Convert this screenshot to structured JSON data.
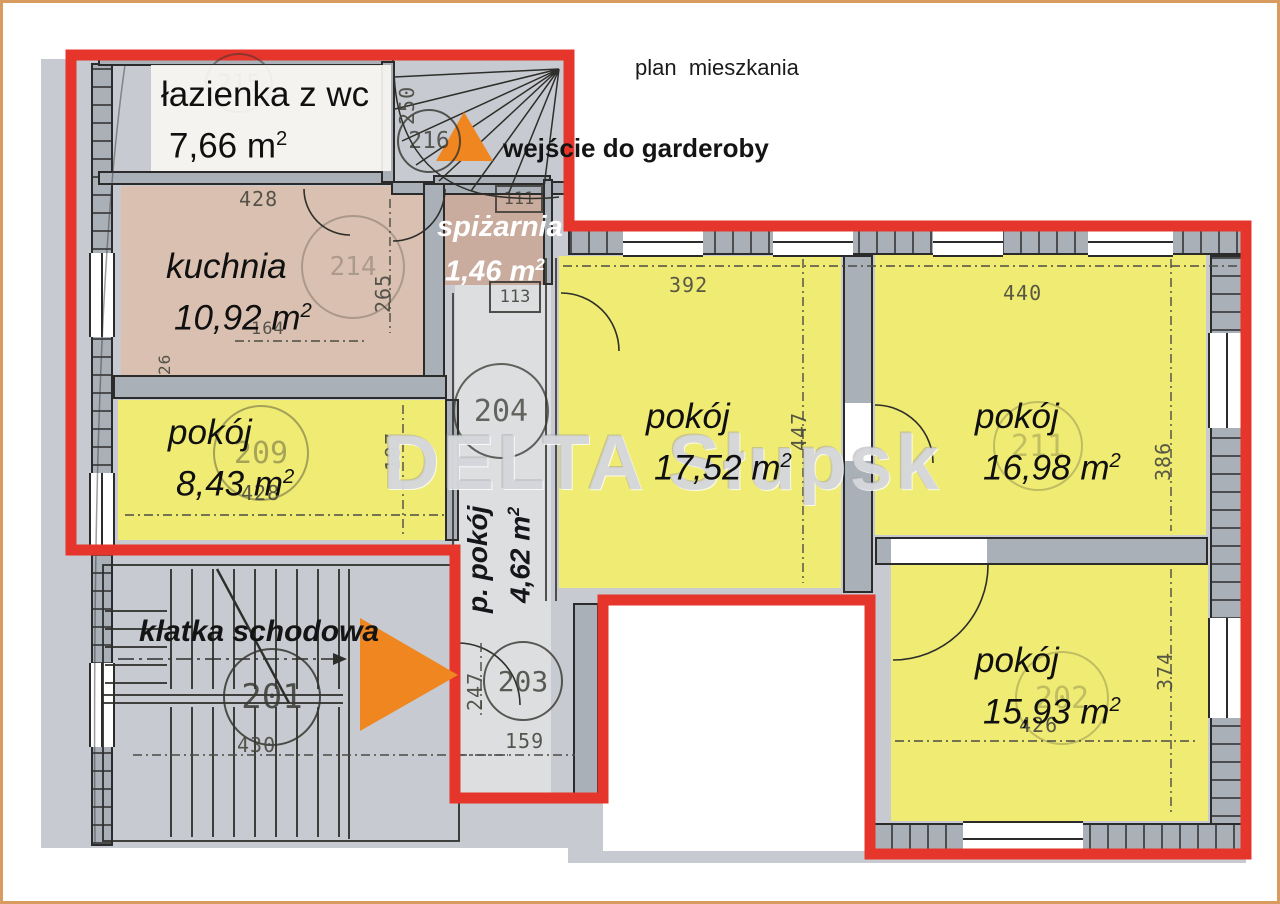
{
  "title": "plan  mieszkania",
  "watermark": "DELTA Słupsk",
  "labels": {
    "wardrobe_entrance": "wejście do garderoby",
    "staircase": "klatka schodowa"
  },
  "units": {
    "m": "m",
    "sup": "2"
  },
  "rooms": {
    "lazienka": {
      "name": "łazienka z wc",
      "area": "7,66"
    },
    "kuchnia": {
      "name": "kuchnia",
      "area": "10,92"
    },
    "pokoj_maly": {
      "name": "pokój",
      "area": "8,43"
    },
    "spizarnia": {
      "name": "spiżarnia",
      "area": "1,46"
    },
    "przedpokoj": {
      "name": "p. pokój",
      "area": "4,62"
    },
    "pokoj_17": {
      "name": "pokój",
      "area": "17,52"
    },
    "pokoj_16": {
      "name": "pokój",
      "area": "16,98"
    },
    "pokoj_15": {
      "name": "pokój",
      "area": "15,93"
    }
  },
  "dims": {
    "kuchnia_top": "428",
    "kuchnia_right": "265",
    "stairs_top": "250",
    "kuchnia_inner": "164",
    "kuchnia_small": "26",
    "pokoj_maly_right": "197",
    "pokoj_maly_bottom": "428",
    "pokoj_17_top": "392",
    "pokoj_17_right": "447",
    "pokoj_16_top": "440",
    "pokoj_16_right": "386",
    "pokoj_15_bottom": "426",
    "pokoj_15_right": "374",
    "stairs_bottom": "430",
    "przedpokoj_bottom": "159",
    "przedpokoj_left": "247"
  },
  "numbers": {
    "c215": "215",
    "c216": "216",
    "c214": "214",
    "c209": "209",
    "c204": "204",
    "c201": "201",
    "c203": "203",
    "c211": "211",
    "c202": "202",
    "b111": "111",
    "b113": "113"
  },
  "colors": {
    "outline_red": "#e6352b",
    "arrow_orange": "#f0861f",
    "room_yellow": "#f2ee6c",
    "scan_gray": "#c7cad0",
    "frame_tan": "#d99c60"
  }
}
